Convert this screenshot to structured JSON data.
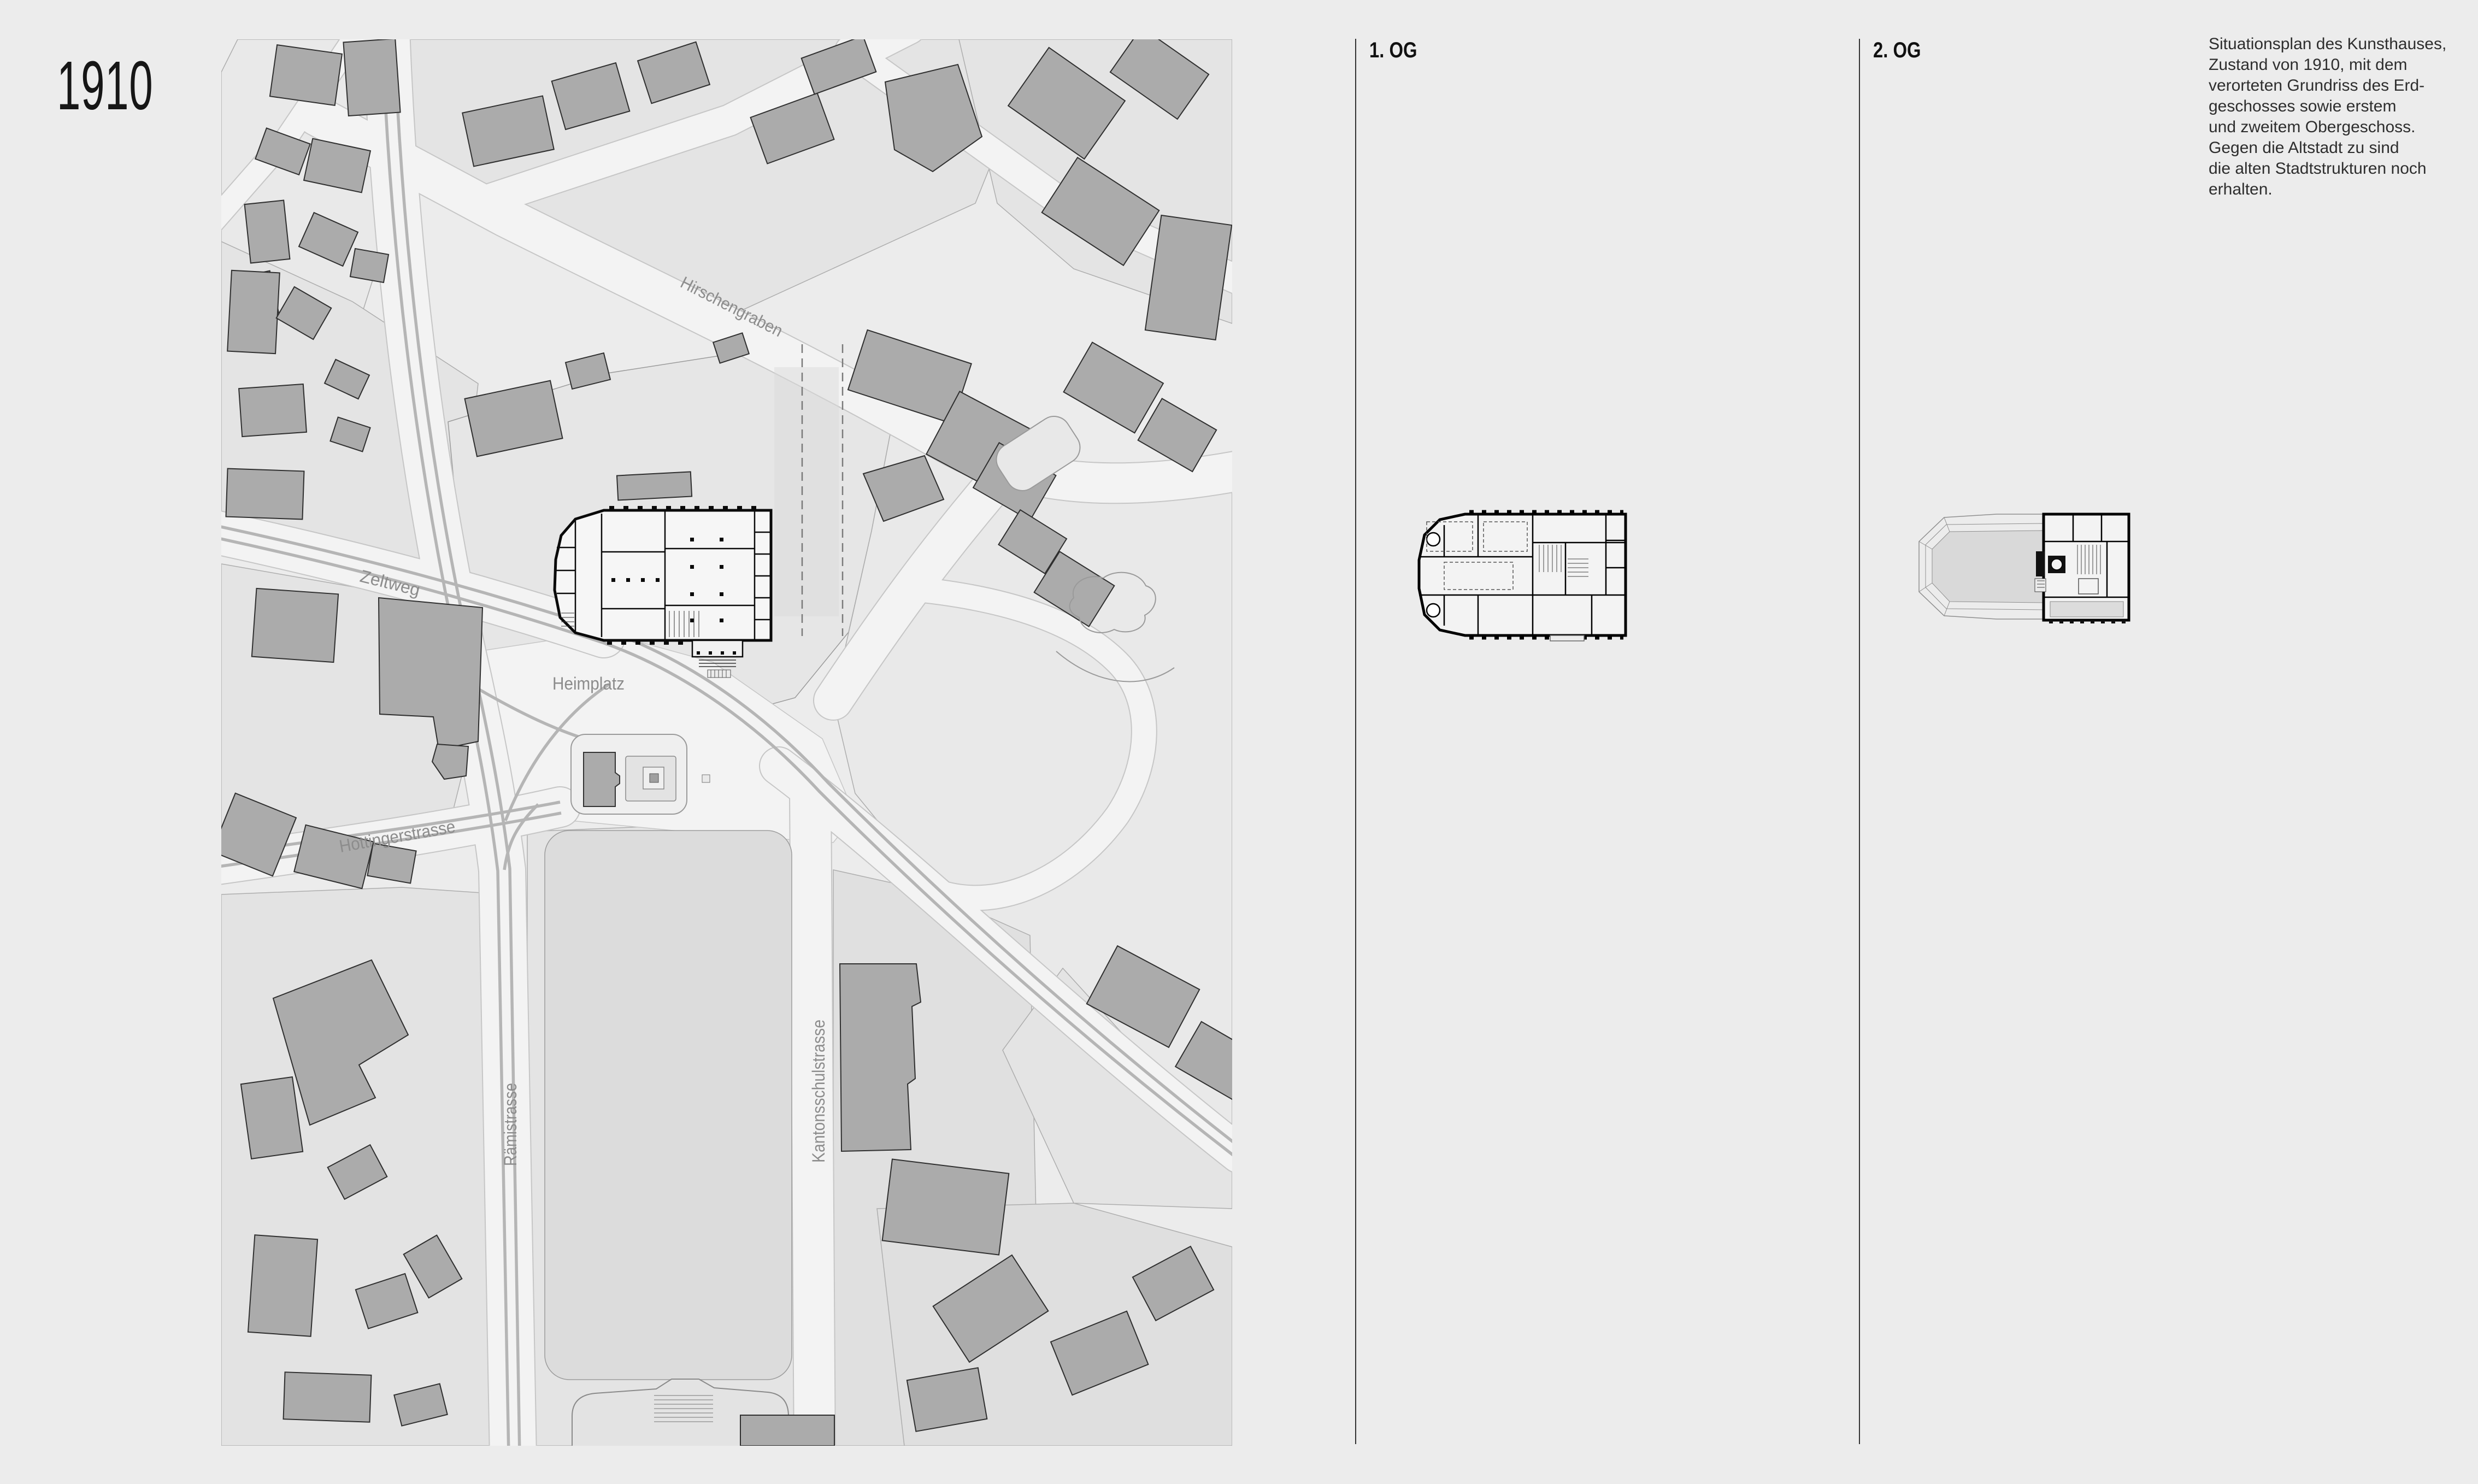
{
  "page": {
    "year": "1910",
    "background_color": "#ececec"
  },
  "panels": {
    "eg": {
      "label": "EG"
    },
    "og1": {
      "label": "1. OG"
    },
    "og2": {
      "label": "2. OG"
    }
  },
  "map": {
    "street_labels": {
      "hirschengraben": "Hirschengraben",
      "zeltweg": "Zeltweg",
      "heimplatz": "Heimplatz",
      "hottingerstrasse": "Hottingerstrasse",
      "raemistrasse": "Rämistrasse",
      "kantonsschulstrasse": "Kantonsschulstrasse"
    }
  },
  "caption": {
    "lines": [
      "Situationsplan des Kunsthauses,",
      "Zustand von 1910, mit dem",
      "verorteten Grundriss des Erd-",
      "geschosses sowie erstem",
      "und zweitem Obergeschoss.",
      "Gegen die Altstadt zu sind",
      "die alten Stadtstrukturen noch",
      "erhalten."
    ]
  },
  "colors": {
    "background": "#ececec",
    "street": "#f3f3f3",
    "parcel": "#e4e4e4",
    "building": "#ababab",
    "building_outline": "#2f2f2f",
    "tram_line": "#b5b5b5",
    "plan_wall": "#0a0a0a",
    "street_label_text": "#8c8c8c",
    "caption_text": "#2e2e2e"
  }
}
